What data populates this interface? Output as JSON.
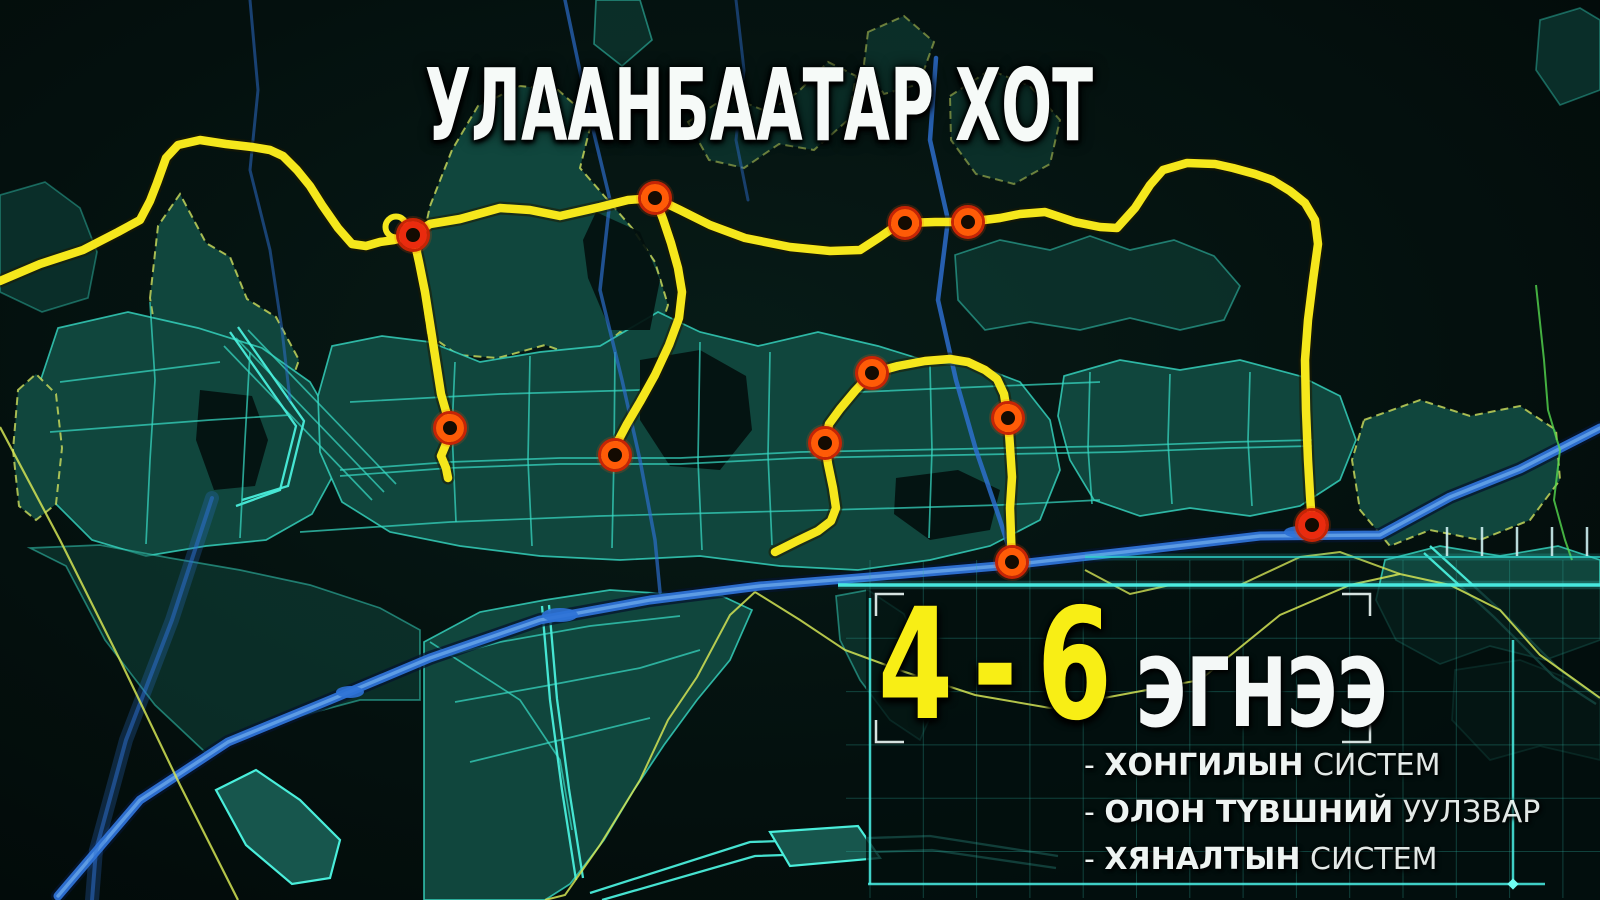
{
  "title": "УЛААНБААТАР ХОТ",
  "panel": {
    "headline": {
      "number": "4-6",
      "unit": "ЭГНЭЭ"
    },
    "bullets": [
      {
        "dash": "-",
        "bold": "ХОНГИЛЫН",
        "rest": "СИСТЕМ"
      },
      {
        "dash": "-",
        "bold": "ОЛОН ТҮВШНИЙ",
        "rest": "УУЛЗВАР"
      },
      {
        "dash": "-",
        "bold": "ХЯНАЛТЫН",
        "rest": "СИСТЕМ"
      }
    ]
  },
  "colors": {
    "background": "#04100e",
    "district_fill": "#10463d",
    "road_cyan": "#37d9c4",
    "boundary_yellow_green": "#d3e455",
    "boundary_green": "#55d84f",
    "river_blue": "#2e72d6",
    "river_highlight": "#6aa7ea",
    "river_casing": "#06142e",
    "route_yellow": "#f5e71c",
    "route_casing": "#1e1a00",
    "node_ring_orange": "#ff5b07",
    "node_ring_red": "#ea2b0e",
    "node_outer": "#c62405",
    "node_core": "#140b02",
    "bright_cyan": "#4af0e6",
    "grid_teal": "#2fae9f",
    "bracket_white": "#e8f4f2",
    "headline_yellow": "#f8ee15",
    "text_white": "#f4f8f7"
  },
  "map": {
    "nodes": [
      {
        "x": 413,
        "y": 235,
        "red": true
      },
      {
        "x": 655,
        "y": 198
      },
      {
        "x": 905,
        "y": 223
      },
      {
        "x": 968,
        "y": 222
      },
      {
        "x": 450,
        "y": 428
      },
      {
        "x": 615,
        "y": 455
      },
      {
        "x": 872,
        "y": 373
      },
      {
        "x": 825,
        "y": 443
      },
      {
        "x": 1008,
        "y": 418
      },
      {
        "x": 1012,
        "y": 562
      },
      {
        "x": 1312,
        "y": 525,
        "red": true
      }
    ],
    "loop_circle": {
      "x": 396,
      "y": 227,
      "r": 10.5
    },
    "routes": {
      "main": [
        [
          0,
          281
        ],
        [
          40,
          264
        ],
        [
          83,
          250
        ],
        [
          118,
          232
        ],
        [
          140,
          220
        ],
        [
          150,
          201
        ],
        [
          157,
          183
        ],
        [
          166,
          158
        ],
        [
          178,
          145
        ],
        [
          200,
          140
        ],
        [
          226,
          144
        ],
        [
          252,
          147
        ],
        [
          270,
          150
        ],
        [
          283,
          156
        ],
        [
          297,
          170
        ],
        [
          310,
          186
        ],
        [
          322,
          205
        ],
        [
          338,
          228
        ],
        [
          352,
          244
        ],
        [
          366,
          246
        ],
        [
          380,
          242
        ],
        [
          394,
          240
        ],
        [
          405,
          237
        ],
        [
          413,
          235
        ],
        [
          430,
          224
        ],
        [
          460,
          219
        ],
        [
          500,
          208
        ],
        [
          530,
          210
        ],
        [
          560,
          216
        ],
        [
          600,
          207
        ],
        [
          628,
          200
        ],
        [
          655,
          198
        ],
        [
          680,
          210
        ],
        [
          710,
          225
        ],
        [
          745,
          238
        ],
        [
          790,
          247
        ],
        [
          830,
          251
        ],
        [
          860,
          250
        ],
        [
          880,
          237
        ],
        [
          893,
          228
        ],
        [
          905,
          223
        ],
        [
          935,
          222
        ],
        [
          968,
          222
        ],
        [
          1000,
          218
        ],
        [
          1020,
          214
        ],
        [
          1045,
          212
        ],
        [
          1075,
          222
        ],
        [
          1100,
          227
        ],
        [
          1117,
          228
        ],
        [
          1135,
          208
        ],
        [
          1150,
          185
        ],
        [
          1163,
          170
        ],
        [
          1187,
          163
        ],
        [
          1215,
          164
        ],
        [
          1233,
          168
        ],
        [
          1255,
          174
        ],
        [
          1272,
          180
        ],
        [
          1290,
          191
        ],
        [
          1305,
          203
        ],
        [
          1315,
          220
        ],
        [
          1318,
          244
        ],
        [
          1313,
          280
        ],
        [
          1308,
          320
        ],
        [
          1305,
          360
        ],
        [
          1306,
          410
        ],
        [
          1308,
          460
        ],
        [
          1310,
          495
        ],
        [
          1312,
          525
        ]
      ],
      "branch_north_west": [
        [
          413,
          235
        ],
        [
          419,
          262
        ],
        [
          425,
          292
        ],
        [
          431,
          330
        ],
        [
          436,
          362
        ],
        [
          441,
          394
        ],
        [
          447,
          415
        ],
        [
          450,
          428
        ],
        [
          446,
          444
        ],
        [
          441,
          456
        ],
        [
          446,
          468
        ],
        [
          448,
          478
        ]
      ],
      "branch_north_center": [
        [
          655,
          198
        ],
        [
          663,
          219
        ],
        [
          671,
          243
        ],
        [
          678,
          268
        ],
        [
          682,
          292
        ],
        [
          679,
          318
        ],
        [
          669,
          345
        ],
        [
          655,
          375
        ],
        [
          640,
          402
        ],
        [
          627,
          424
        ],
        [
          618,
          441
        ],
        [
          615,
          455
        ]
      ],
      "inner_loop": [
        [
          775,
          552
        ],
        [
          797,
          541
        ],
        [
          818,
          531
        ],
        [
          831,
          521
        ],
        [
          836,
          508
        ],
        [
          833,
          488
        ],
        [
          828,
          464
        ],
        [
          825,
          443
        ],
        [
          829,
          424
        ],
        [
          840,
          409
        ],
        [
          855,
          391
        ],
        [
          872,
          373
        ],
        [
          898,
          366
        ],
        [
          925,
          361
        ],
        [
          950,
          359
        ],
        [
          968,
          362
        ],
        [
          985,
          370
        ],
        [
          997,
          379
        ],
        [
          1004,
          394
        ],
        [
          1008,
          418
        ],
        [
          1010,
          447
        ],
        [
          1012,
          477
        ],
        [
          1010,
          508
        ],
        [
          1011,
          536
        ],
        [
          1012,
          562
        ]
      ]
    },
    "rivers": [
      {
        "name": "tuul-river",
        "major": true,
        "w": 9,
        "o": 0.95,
        "pts": [
          [
            58,
            896
          ],
          [
            140,
            800
          ],
          [
            228,
            742
          ],
          [
            330,
            700
          ],
          [
            430,
            658
          ],
          [
            540,
            620
          ],
          [
            650,
            600
          ],
          [
            760,
            586
          ],
          [
            870,
            577
          ],
          [
            1010,
            565
          ],
          [
            1150,
            549
          ],
          [
            1260,
            536
          ],
          [
            1380,
            535
          ],
          [
            1450,
            497
          ],
          [
            1520,
            469
          ],
          [
            1600,
            428
          ]
        ]
      },
      {
        "name": "selbe-river",
        "w": 4.5,
        "o": 0.8,
        "pts": [
          [
            936,
            58
          ],
          [
            930,
            140
          ],
          [
            948,
            220
          ],
          [
            938,
            300
          ],
          [
            956,
            380
          ],
          [
            976,
            450
          ],
          [
            1000,
            520
          ],
          [
            1012,
            558
          ]
        ]
      },
      {
        "name": "west-stream",
        "w": 3.5,
        "o": 0.65,
        "pts": [
          [
            565,
            0
          ],
          [
            586,
            100
          ],
          [
            610,
            200
          ],
          [
            600,
            290
          ],
          [
            622,
            380
          ],
          [
            640,
            460
          ],
          [
            655,
            540
          ],
          [
            660,
            592
          ]
        ]
      },
      {
        "name": "nw-stream",
        "w": 3,
        "o": 0.5,
        "pts": [
          [
            250,
            0
          ],
          [
            258,
            90
          ],
          [
            250,
            170
          ],
          [
            270,
            250
          ],
          [
            282,
            330
          ],
          [
            290,
            400
          ]
        ]
      },
      {
        "name": "title-stream",
        "w": 3,
        "o": 0.45,
        "pts": [
          [
            736,
            0
          ],
          [
            744,
            70
          ],
          [
            736,
            140
          ],
          [
            748,
            200
          ]
        ]
      },
      {
        "name": "sw-glow-stream",
        "w": 14,
        "o": 0.26,
        "pts": [
          [
            212,
            498
          ],
          [
            172,
            620
          ],
          [
            126,
            740
          ],
          [
            96,
            850
          ],
          [
            92,
            900
          ]
        ]
      },
      {
        "name": "sw-stream-core",
        "w": 4,
        "o": 0.5,
        "pts": [
          [
            212,
            498
          ],
          [
            172,
            620
          ],
          [
            126,
            740
          ],
          [
            96,
            850
          ],
          [
            92,
            900
          ]
        ]
      }
    ],
    "boundaries": [
      {
        "name": "southwest-diagonal",
        "c": "#d3e455",
        "w": 2.2,
        "o": 0.85,
        "pts": [
          [
            0,
            427
          ],
          [
            60,
            540
          ],
          [
            120,
            660
          ],
          [
            180,
            785
          ],
          [
            238,
            900
          ]
        ]
      },
      {
        "name": "peninsula-east-edge",
        "c": "#d3e455",
        "w": 2,
        "o": 0.85,
        "pts": [
          [
            755,
            592
          ],
          [
            730,
            615
          ],
          [
            697,
            677
          ],
          [
            668,
            720
          ],
          [
            640,
            780
          ],
          [
            600,
            845
          ],
          [
            565,
            895
          ],
          [
            545,
            900
          ]
        ]
      },
      {
        "name": "south-bank-long",
        "c": "#d3e455",
        "w": 2,
        "o": 0.85,
        "pts": [
          [
            755,
            592
          ],
          [
            800,
            620
          ],
          [
            845,
            650
          ],
          [
            905,
            672
          ],
          [
            975,
            695
          ],
          [
            1050,
            708
          ],
          [
            1120,
            695
          ],
          [
            1200,
            680
          ],
          [
            1280,
            615
          ],
          [
            1350,
            585
          ],
          [
            1400,
            574
          ],
          [
            1450,
            585
          ],
          [
            1500,
            610
          ],
          [
            1540,
            655
          ],
          [
            1575,
            680
          ],
          [
            1600,
            698
          ]
        ]
      },
      {
        "name": "river-south-wavy",
        "c": "#d3e455",
        "w": 2,
        "o": 0.8,
        "pts": [
          [
            1085,
            570
          ],
          [
            1130,
            594
          ],
          [
            1170,
            585
          ],
          [
            1240,
            585
          ],
          [
            1300,
            557
          ],
          [
            1340,
            552
          ],
          [
            1400,
            574
          ]
        ]
      },
      {
        "name": "far-right-green",
        "c": "#55d84f",
        "w": 2,
        "o": 0.8,
        "pts": [
          [
            1536,
            285
          ],
          [
            1544,
            360
          ],
          [
            1548,
            410
          ],
          [
            1560,
            450
          ],
          [
            1554,
            500
          ],
          [
            1565,
            540
          ],
          [
            1572,
            560
          ]
        ]
      }
    ],
    "bright_lines": [
      {
        "x1": 1085,
        "y1": 557,
        "x2": 1600,
        "y2": 557,
        "w": 2,
        "c": "#2fd4cc",
        "o": 0.75
      },
      {
        "x1": 838,
        "y1": 585,
        "x2": 1600,
        "y2": 585,
        "w": 3.5,
        "c": "#4af0e6",
        "o": 0.95
      }
    ],
    "panel_borders": [
      {
        "x1": 870,
        "y1": 598,
        "x2": 870,
        "y2": 884
      },
      {
        "x1": 868,
        "y1": 884,
        "x2": 1545,
        "y2": 884
      },
      {
        "x1": 1513,
        "y1": 640,
        "x2": 1513,
        "y2": 884
      }
    ],
    "border_diamond": {
      "x": 1513,
      "y": 884
    },
    "grid": {
      "x0": 870,
      "y0": 585,
      "step": 53.3,
      "v_count": 14,
      "h_count": 6,
      "y_top": 560,
      "y_bottom": 898,
      "x_left": 846,
      "x_right": 1600
    },
    "ticks": {
      "xs": [
        1447,
        1482,
        1517,
        1552,
        1587
      ],
      "y1": 527,
      "y2": 556
    },
    "bracket_frame": {
      "x1": 876,
      "y1": 594,
      "x2": 1370,
      "y2": 742,
      "arm": 28
    }
  }
}
